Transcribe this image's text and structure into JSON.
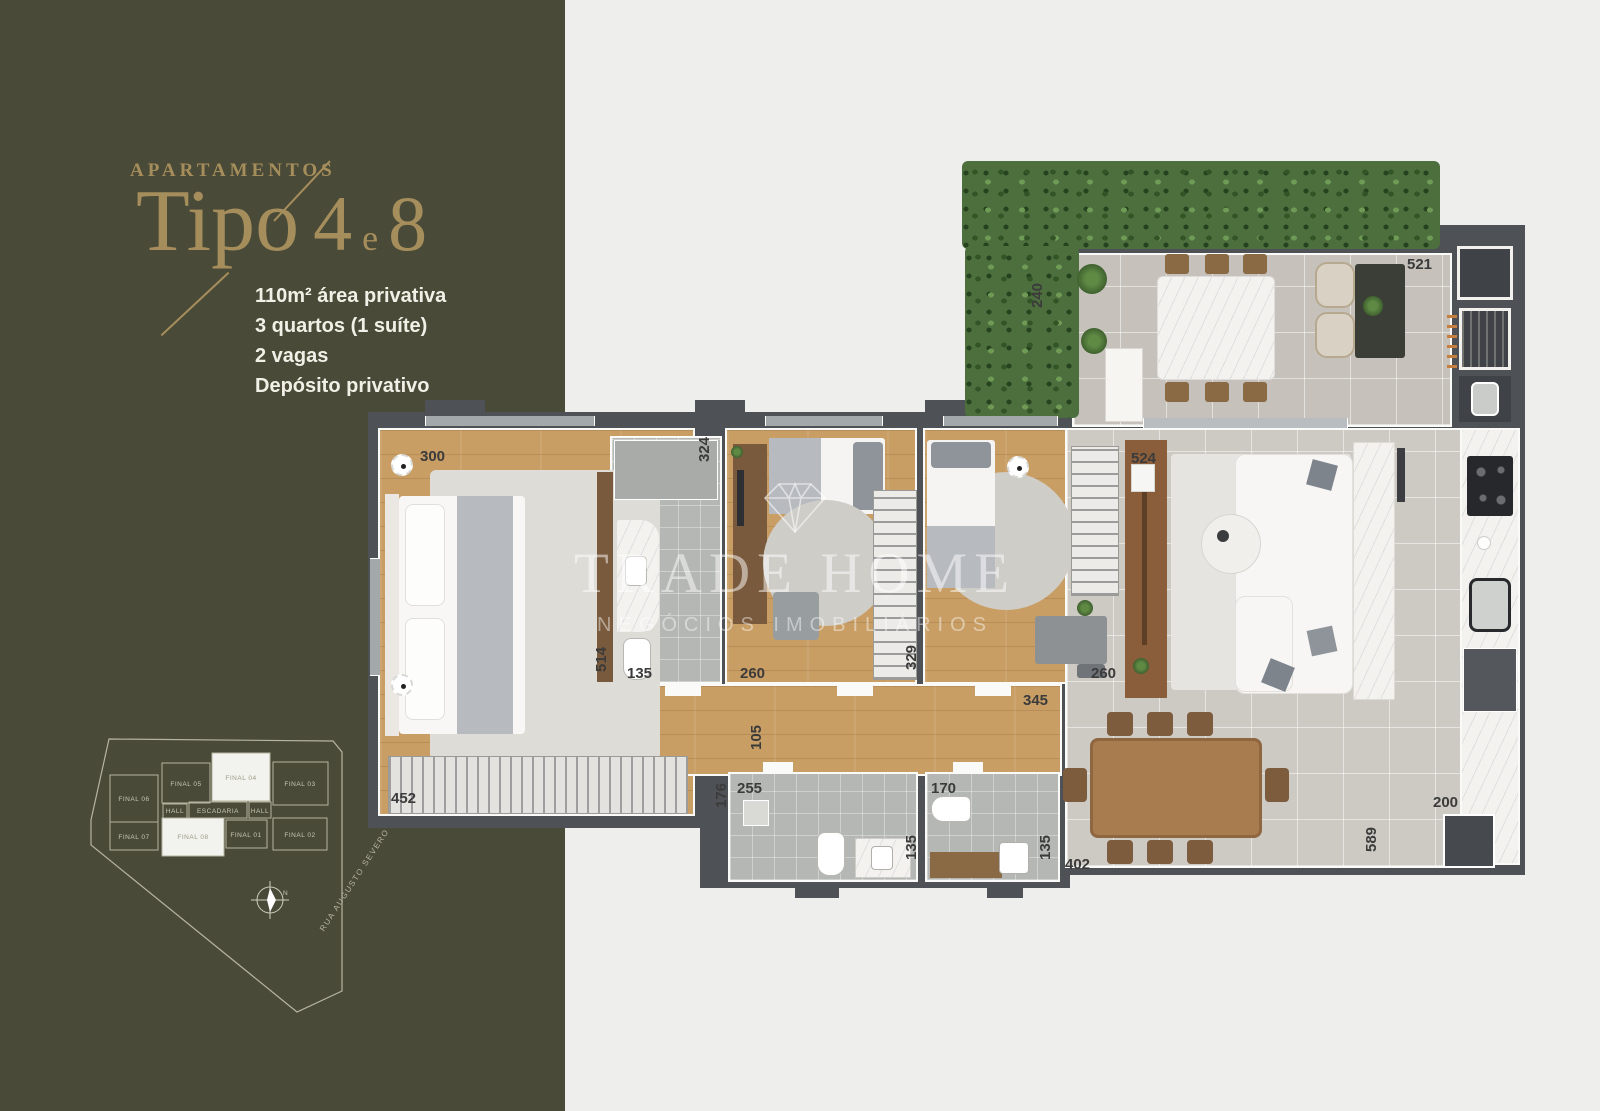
{
  "sidebar": {
    "bg": "#494a37",
    "accent": "#a68e5c",
    "eyebrow": "APARTAMENTOS",
    "title": {
      "word": "Tipo",
      "num_a": "4",
      "connector": "e",
      "num_b": "8"
    },
    "specs": [
      "110m² área privativa",
      "3 quartos (1 suíte)",
      "2 vagas",
      "Depósito privativo"
    ],
    "keyplan": {
      "units": [
        {
          "label": "FINAL 06",
          "highlight": false
        },
        {
          "label": "FINAL 05",
          "highlight": false
        },
        {
          "label": "FINAL 04",
          "highlight": true
        },
        {
          "label": "FINAL 03",
          "highlight": false
        },
        {
          "label": "HALL",
          "highlight": false
        },
        {
          "label": "ESCADARIA",
          "highlight": false
        },
        {
          "label": "HALL",
          "highlight": false
        },
        {
          "label": "FINAL 07",
          "highlight": false
        },
        {
          "label": "FINAL 08",
          "highlight": true
        },
        {
          "label": "FINAL 01",
          "highlight": false
        },
        {
          "label": "FINAL 02",
          "highlight": false
        }
      ],
      "compass": "N",
      "street": "RUA AUGUSTO SEVERO"
    }
  },
  "watermark": {
    "icon": "diamond-icon",
    "brand": "TRADE HOME",
    "tagline": "NEGÓCIOS IMOBILIÁRIOS"
  },
  "plan": {
    "wall_color": "#4e5156",
    "wood_color": "#c99e65",
    "tile_color": "#cdcac4",
    "hedge_color": "#4d6f3e",
    "marble_color": "#f3f2ef",
    "measurements": [
      {
        "v": "300",
        "x": 55,
        "y": 288,
        "r": 0
      },
      {
        "v": "324",
        "x": 331,
        "y": 302,
        "r": 1
      },
      {
        "v": "524",
        "x": 766,
        "y": 290,
        "r": 0
      },
      {
        "v": "521",
        "x": 1042,
        "y": 96,
        "r": 0
      },
      {
        "v": "240",
        "x": 664,
        "y": 148,
        "r": 1
      },
      {
        "v": "514",
        "x": 228,
        "y": 512,
        "r": 1
      },
      {
        "v": "135",
        "x": 262,
        "y": 505,
        "r": 0
      },
      {
        "v": "260",
        "x": 375,
        "y": 505,
        "r": 0
      },
      {
        "v": "329",
        "x": 538,
        "y": 510,
        "r": 1
      },
      {
        "v": "260",
        "x": 726,
        "y": 505,
        "r": 0
      },
      {
        "v": "345",
        "x": 658,
        "y": 532,
        "r": 0
      },
      {
        "v": "105",
        "x": 383,
        "y": 590,
        "r": 1
      },
      {
        "v": "176",
        "x": 348,
        "y": 648,
        "r": 1
      },
      {
        "v": "255",
        "x": 372,
        "y": 620,
        "r": 0
      },
      {
        "v": "170",
        "x": 566,
        "y": 620,
        "r": 0
      },
      {
        "v": "135",
        "x": 538,
        "y": 700,
        "r": 1
      },
      {
        "v": "135",
        "x": 672,
        "y": 700,
        "r": 1
      },
      {
        "v": "402",
        "x": 700,
        "y": 696,
        "r": 0
      },
      {
        "v": "452",
        "x": 26,
        "y": 630,
        "r": 0
      },
      {
        "v": "589",
        "x": 998,
        "y": 692,
        "r": 1
      },
      {
        "v": "200",
        "x": 1068,
        "y": 634,
        "r": 0
      }
    ]
  }
}
